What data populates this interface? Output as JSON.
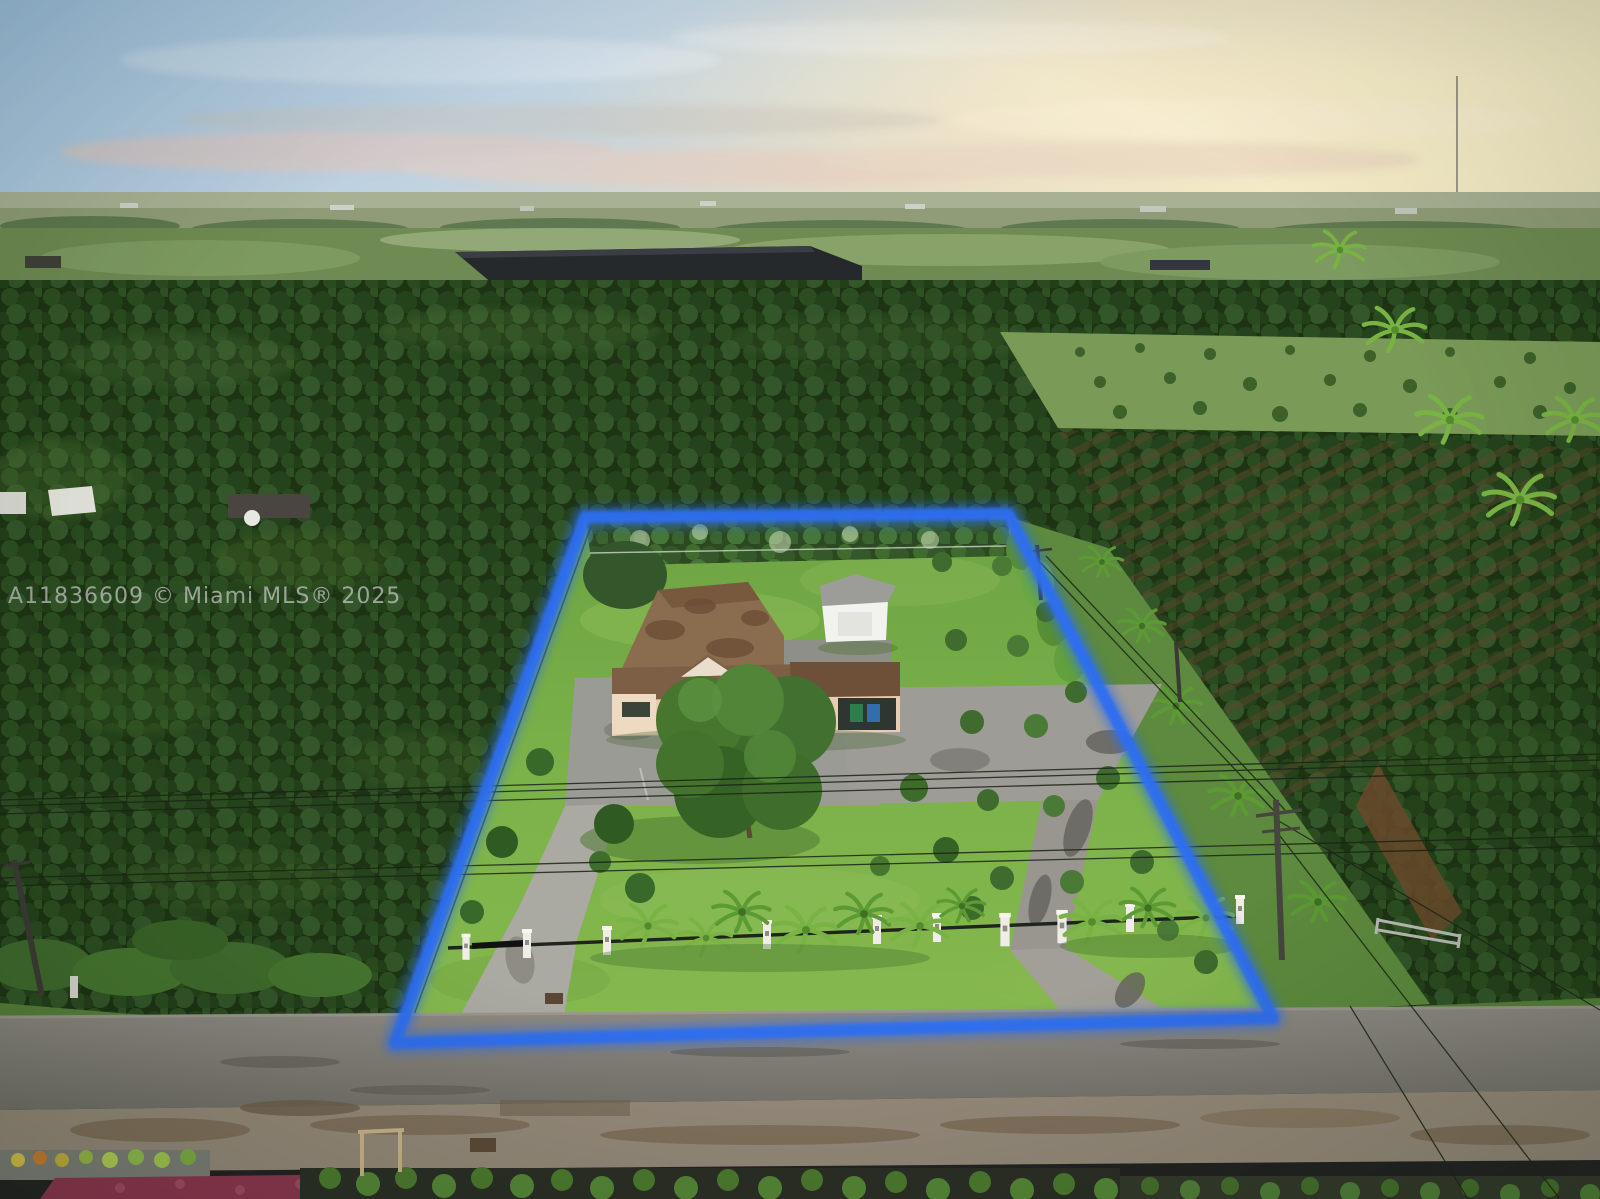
{
  "watermark": {
    "text": "A11836609 © Miami MLS® 2025"
  },
  "colors": {
    "boundary-blue": "#2e6ef0",
    "sky-blue": "#9ec2e2",
    "sunset-yellow": "#f6ecc6",
    "haze-pink": "#e4c4b8",
    "grove-green": "#1d3314",
    "lawn-green": "#7cb24a",
    "roof-brown": "#83654a",
    "house-wall": "#e6cdb4",
    "driveway-gray": "#a3a19b",
    "road-gray": "#7f7c76",
    "pillar-white": "#efede6"
  }
}
